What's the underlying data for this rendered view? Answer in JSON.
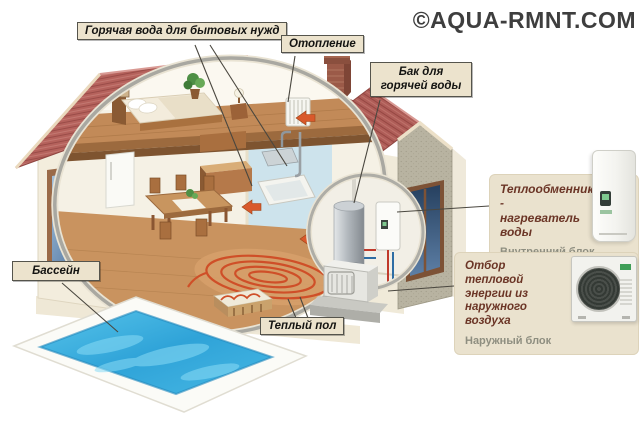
{
  "watermark": "©AQUA-RMNT.COM",
  "labels": {
    "hot_water": "Горячая вода для бытовых нужд",
    "heating": "Отопление",
    "hot_water_tank": "Бак для горячей воды",
    "pool": "Бассейн",
    "warm_floor": "Теплый пол"
  },
  "callouts": {
    "indoor_unit": {
      "title": "Теплообменник - нагреватель воды",
      "subtitle": "Внутренний блок"
    },
    "outdoor_unit": {
      "title": "Отбор тепловой энергии из наружного воздуха",
      "subtitle": "Наружный блок"
    }
  },
  "colors": {
    "roof": "#b5625c",
    "wall": "#f3eddd",
    "annex_wall": "#b8b3a1",
    "pool_water": "#3eb3e0",
    "floor_coil": "#cf4f28",
    "arrow": "#d9592b",
    "label_bg": "#ece3cd",
    "callout_bg": "#eae2ce",
    "callout_title": "#6b3526",
    "callout_sub": "#8e8e80",
    "watermark": "#3e3e3e"
  }
}
